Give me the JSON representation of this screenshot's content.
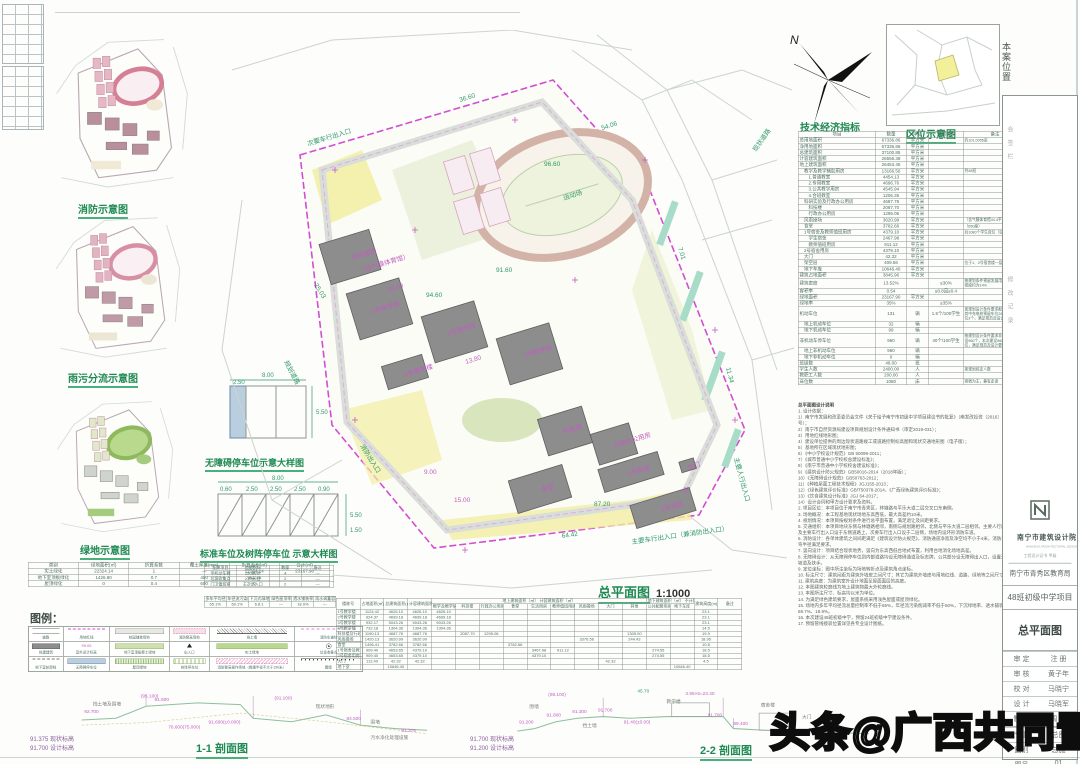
{
  "sheet": {
    "plan_title": "总平面图",
    "plan_scale": "1:1000"
  },
  "thumbnails": {
    "fire": "消防示意图",
    "rain": "雨污分流示意图",
    "green": "绿地示意图"
  },
  "details": {
    "accessible": "无障碍停车位示意大样图",
    "standard": "标准车位及树阵停车位 示意大样图",
    "dims1": [
      "8.00",
      "2.50",
      "5.50"
    ],
    "dims2": [
      "8.00",
      "0.60",
      "2.50",
      "2.50",
      "2.50",
      "0.90",
      "5.50",
      "1.50"
    ]
  },
  "locator": {
    "caption": "区位示意图",
    "site_label": "本案位置",
    "north": "N"
  },
  "green_table": {
    "columns": [
      "类别",
      "绿地面积(㎡)",
      "折算系数",
      "覆土厚度(mm)",
      "折算面积(㎡)",
      "合计(㎡)"
    ],
    "rows": [
      [
        "实土绿化",
        "22324.14",
        "1",
        "—",
        "22324.14",
        "23167.90"
      ],
      [
        "地下室顶板绿化",
        "1426.80",
        "0.7",
        "450",
        "961.76",
        ""
      ],
      [
        "屋顶绿化",
        "0",
        "0.4",
        "600",
        "0",
        ""
      ]
    ]
  },
  "facility_table": {
    "columns": [
      "配建项目",
      "控制指标",
      "数量",
      "备注"
    ],
    "rows": [
      [
        "非机动车棚",
        "150辆/处",
        "4",
        "—"
      ],
      [
        "垃圾收集点",
        "≥10㎡/处",
        "2",
        "—"
      ],
      [
        "门卫值班室",
        "主次出入口",
        "2",
        "—"
      ]
    ]
  },
  "sponge_table": {
    "columns": [
      "多年平均径流总量控制率",
      "年径流污染削减率",
      "下沉式绿地率",
      "绿色屋顶率",
      "透水铺装率",
      "雨水调蓄容积"
    ],
    "values": [
      "65.1%",
      "69.1%",
      "6.8:1",
      "—",
      "18.9%",
      "—"
    ]
  },
  "econ": {
    "title": "技术经济指标",
    "columns": [
      "项目",
      "数量",
      "单位",
      "规划条件",
      "备注"
    ],
    "rows": [
      [
        0,
        "总用地面积",
        "67336.86",
        "平方米",
        "",
        "约101.0055亩"
      ],
      [
        0,
        "净用地面积",
        "67336.86",
        "平方米",
        "",
        ""
      ],
      [
        0,
        "总建筑面积",
        "37100.85",
        "平方米",
        "",
        ""
      ],
      [
        0,
        "计容建筑面积",
        "26556.38",
        "平方米",
        "",
        ""
      ],
      [
        0,
        "地上建筑面积",
        "26453.45",
        "平方米",
        "",
        ""
      ],
      [
        1,
        "教学及教学辅助用房",
        "13166.56",
        "平方米",
        "",
        "共48班"
      ],
      [
        2,
        "1.普通教室",
        "4454.13",
        "平方米",
        "",
        ""
      ],
      [
        2,
        "2.专用教室",
        "4696.76",
        "平方米",
        "",
        ""
      ],
      [
        2,
        "3.公共教学用房",
        "4545.94",
        "平方米",
        "",
        ""
      ],
      [
        2,
        "4.合班教室",
        "1206.35",
        "平方米",
        "",
        ""
      ],
      [
        1,
        "科研实验及行政办公用房",
        "4687.76",
        "平方米",
        "",
        ""
      ],
      [
        2,
        "科技楼",
        "2087.70",
        "平方米",
        "",
        ""
      ],
      [
        2,
        "行政办公用房",
        "1295.06",
        "平方米",
        "",
        ""
      ],
      [
        1,
        "风雨操场",
        "3620.99",
        "平方米",
        "",
        "（含气膜体育馆44.4平方米）"
      ],
      [
        1,
        "食堂",
        "3782.66",
        "平方米",
        "",
        "（650座）"
      ],
      [
        1,
        "1号宿舍及教师值班用房",
        "4379.10",
        "平方米",
        "",
        "共1080个学生床位（见备注）"
      ],
      [
        2,
        "学生宿舍",
        "2467.98",
        "平方米",
        "",
        ""
      ],
      [
        2,
        "教师值班用房",
        "911.12",
        "平方米",
        "",
        ""
      ],
      [
        1,
        "2号宿舍用房",
        "4379.10",
        "平方米",
        "",
        ""
      ],
      [
        1,
        "大门",
        "42.32",
        "平方米",
        "",
        ""
      ],
      [
        1,
        "架空层",
        "409.56",
        "平方米",
        "",
        "位于1、2号宿舍楼一层"
      ],
      [
        1,
        "地下车库",
        "10646.40",
        "平方米",
        "",
        ""
      ],
      [
        0,
        "建筑占地面积",
        "3845.96",
        "平方米",
        "",
        ""
      ],
      [
        0,
        "建筑密度",
        "13.52%",
        "",
        "≤30%",
        "按规划条件预留发展用地后本期建筑密度约为14%"
      ],
      [
        0,
        "容积率",
        "0.54",
        "",
        "≤0.8且≥0.4",
        ""
      ],
      [
        0,
        "绿地面积",
        "23167.90",
        "平方米",
        "",
        ""
      ],
      [
        0,
        "绿地率",
        "35%",
        "",
        "≥35%",
        ""
      ],
      [
        0,
        "机动车位",
        "131",
        "辆",
        "1.5个/100学生",
        "按规划设计条件要求配建机动车位，其中充电桩预留车位26个、无障碍车位3个，满足规范及设计要求"
      ],
      [
        1,
        "地上机动车位",
        "32",
        "辆",
        "",
        ""
      ],
      [
        1,
        "地下机动车位",
        "99",
        "辆",
        "",
        ""
      ],
      [
        0,
        "非机动车停车位",
        "960",
        "辆",
        "40个/100学生",
        "按规划设计条件要求非机动车位需建设960个，本次建设960个非机动车位，满足规范及设计要求"
      ],
      [
        1,
        "地上非机动车位",
        "960",
        "辆",
        "",
        ""
      ],
      [
        1,
        "地下非机动车位",
        "0",
        "辆",
        "",
        ""
      ],
      [
        0,
        "班级数",
        "48.00",
        "班",
        "",
        ""
      ],
      [
        0,
        "学生人数",
        "2400.00",
        "人",
        "",
        "按规划核定人数"
      ],
      [
        0,
        "教职工人数",
        "200.00",
        "人",
        "",
        ""
      ],
      [
        0,
        "床位数",
        "1080",
        "床",
        "",
        "寄宿为主，兼有走读"
      ]
    ]
  },
  "notes": {
    "title": "总平面图设计说明",
    "lines": [
      "1. 设计依据：",
      "1）南宁市发展和改革委员会文件《关于给予南宁市初级中学项目建议书的批复》（南发改投资〔2016〕16号）；",
      "2）南宁市自然资源局建设项目规划设计条件通知书（审定2019-031）；",
      "3）用地红线地形图；",
      "4）建设单位提供的周边现状道路竣工或道路控制标高图和现状交通地形图（电子版）；",
      "5）基地所在区域现状地形图；",
      "6）《中小学校设计规范》GB 50099-2011；",
      "7）《城市普通中小学校校舍建设标准》；",
      "8）《南宁市普通中小学校校舍建设标准》；",
      "9）《建筑设计防火规范》GB50016-2014（2018年版）；",
      "10）《无障碍设计规范》GB50763-2012；",
      "11）《种植屋面工程技术规程》JGJ155-2013；",
      "12）《绿色建筑评价标准》GB/T50378-2014、《广西绿色建筑评价标准》；",
      "13）《饮食建筑设计标准》JGJ 64-2017；",
      "14）设计合同和甲方设计要求及资料。",
      "2. 项目区位：本项目位于南宁市青秀区，林塘路与平乐大道二层交叉口东南侧。",
      "3. 场地概况：本工程基地现状场地东高西低，最大高差约10米。",
      "4. 规划情况：本项目按规划条件进行总平面布置，满足退让及间距要求。",
      "5. 交通组织：本项目地块东侧与林塘路相邻，南侧与规划路相邻，北侧与平乐大道二层相邻。主要人行出入口及主要车行出入口设于东侧道路上，次要车行出入口设于二层侧，场地内设环形消防车道。",
      "6. 消防设计：各单体建筑之间间距满足《建筑设计防火规范》，消防通道净宽及净空均不小于4米，消防车道转弯半径满足要求。",
      "7. 竖向设计：项目结合现状地势，竖向为东高西低台地式布置，利用台地消化场地高差。",
      "8. 无障碍设计：从无障碍停车位到内部道路均设无障碍通道及标志牌，公共部分设无障碍出入口，设置无障碍坡道及扶手。",
      "9. 定位坐标：图中所注坐标为场地转折点及建筑角点坐标。",
      "10. 标注尺寸：建筑间距为建筑外墙皮之间尺寸；其它为建筑外墙皮与用地红线、道路、绿地等之间尺寸。",
      "11. 建筑高度：为建筑室外设计地面至屋面面层的高度。",
      "12. 本图建筑轮廓线为地上建筑物最大外轮廓线。",
      "13. 本图所注尺寸、标高均以米为单位。",
      "14. 为满足绿色建筑要求，屋面系统采用浅色屋面或屋顶绿化。",
      "15. 场地内多年平均径流总量控制率不低于65%，年径流污染削减率不低于50%，下沉绿地率、透水铺装率为69.7%、18.9%。",
      "16. 本次建设48班初级中学，预留24班初级中学建设条件。",
      "17. 预留管线接驳位置详见各专业设计图纸。"
    ]
  },
  "legend": {
    "title": "图例：",
    "level_value": "99.05",
    "cells": [
      {
        "sym": "road",
        "label": "道路"
      },
      {
        "sym": "redline",
        "label": "用地红线"
      },
      {
        "sym": "paving",
        "label": "校园铺装场地"
      },
      {
        "sym": "fireline",
        "label": "消防登高场地"
      },
      {
        "sym": "retain",
        "label": "挡土墙"
      },
      {
        "sym": "firelane",
        "label": "消防车道线"
      },
      {
        "sym": "bldg",
        "label": "拟建建筑"
      },
      {
        "sym": "level",
        "label": "室外设计标高"
      },
      {
        "sym": "podium",
        "label": "地下室顶板覆土绿地"
      },
      {
        "sym": "entry",
        "label": "出入口"
      },
      {
        "sym": "solid-green",
        "label": "实土绿地"
      },
      {
        "sym": "trash",
        "label": "垃圾收集点"
      },
      {
        "sym": "basement",
        "label": "地下室轮廓线"
      },
      {
        "sym": "acc-park",
        "label": "无障碍停车位"
      },
      {
        "sym": "roof-green",
        "label": "屋顶绿地"
      },
      {
        "sym": "tree-park",
        "label": "树阵停车位"
      },
      {
        "sym": "fire-op",
        "label": "消防登高操作场地（救援半径不大于150米）"
      },
      {
        "sym": "wall",
        "label": "围墙"
      }
    ]
  },
  "building_table": {
    "h": {
      "col_no": "楼栋号",
      "col_fp": "占地面积(㎡)",
      "col_total": "总建筑面积(㎡)",
      "col_cap": "计容建筑面积(㎡)",
      "grp_above": "地上建筑面积（㎡）",
      "grp_cap": "计容建筑面积（㎡）",
      "sub": [
        "教学及教学辅助用房",
        "科技楼",
        "行政办公用房",
        "食堂",
        "生活用房",
        "教师值班用房",
        "风雨操场",
        "大门",
        "其他"
      ],
      "grp_below": "地下建筑面积（㎡）",
      "grp_nocap": "不计容建筑面积（㎡）",
      "sub2": [
        "公共配套用房",
        "地下车库"
      ],
      "col_h": "建筑高度(m)",
      "col_rm": "备注"
    },
    "rows": [
      [
        "1号教学楼",
        "1124.42",
        "4626.10",
        "4626.10",
        "4626.10",
        "",
        "",
        "",
        "",
        "",
        "",
        "",
        "",
        "",
        "",
        "23.1",
        ""
      ],
      [
        "2号教学楼",
        "924.37",
        "4699.18",
        "4699.18",
        "4699.18",
        "",
        "",
        "",
        "",
        "",
        "",
        "",
        "",
        "",
        "",
        "23.1",
        ""
      ],
      [
        "3号教学楼",
        "932.17",
        "5043.26",
        "5043.26",
        "5043.26",
        "",
        "",
        "",
        "",
        "",
        "",
        "",
        "",
        "",
        "",
        "23.1",
        ""
      ],
      [
        "4号教学楼",
        "732.18",
        "1304.36",
        "1304.36",
        "1304.36",
        "",
        "",
        "",
        "",
        "",
        "",
        "",
        "",
        "",
        "",
        "14.5",
        ""
      ],
      [
        "科技楼及行政办公用房",
        "1190.13",
        "4687.76",
        "4687.76",
        "",
        "2087.70",
        "1295.06",
        "",
        "",
        "",
        "",
        "",
        "1305.00",
        "",
        "",
        "19.9",
        ""
      ],
      [
        "风雨操场",
        "1420.13",
        "3620.99",
        "3620.99",
        "",
        "",
        "",
        "",
        "",
        "",
        "3376.56",
        "",
        "244.43",
        "",
        "",
        "18.95",
        ""
      ],
      [
        "食堂",
        "1496.41",
        "3782.66",
        "3782.66",
        "",
        "",
        "",
        "3782.66",
        "",
        "",
        "",
        "",
        "",
        "",
        "",
        "10.8",
        ""
      ],
      [
        "1号宿舍及教师值班用房",
        "909.40",
        "4653.65",
        "4379.10",
        "",
        "",
        "",
        "",
        "3467.98",
        "911.12",
        "",
        "",
        "",
        "274.55",
        "",
        "18.5",
        ""
      ],
      [
        "2号宿舍用房",
        "909.40",
        "4653.65",
        "4379.10",
        "",
        "",
        "",
        "",
        "4379.10",
        "",
        "",
        "",
        "",
        "274.55",
        "",
        "18.5",
        ""
      ],
      [
        "大门",
        "112.40",
        "42.32",
        "42.32",
        "",
        "",
        "",
        "",
        "",
        "",
        "",
        "42.32",
        "",
        "",
        "",
        "4.5",
        ""
      ],
      [
        "地下室",
        "",
        "10646.40",
        "",
        "",
        "",
        "",
        "",
        "",
        "",
        "",
        "",
        "",
        "",
        "10646.40",
        "",
        ""
      ]
    ]
  },
  "sections": {
    "s1": {
      "caption": "1-1 剖面图",
      "legend": [
        [
          "91.375",
          "现状标高"
        ],
        [
          "91.700",
          "设计标高"
        ]
      ],
      "labels": [
        {
          "x": 18,
          "y": 34,
          "t": "92.700",
          "c": "m"
        },
        {
          "x": 84,
          "y": 16,
          "t": "(95.100)",
          "c": "m"
        },
        {
          "x": 28,
          "y": 25,
          "t": "挡土墙及围墙",
          "c": "k"
        },
        {
          "x": 100,
          "y": 20,
          "t": "91.800",
          "c": "m"
        },
        {
          "x": 116,
          "y": 52,
          "t": "76.600(75.000)",
          "c": "m"
        },
        {
          "x": 163,
          "y": 46,
          "t": "91.600(±0.000)",
          "c": "m"
        },
        {
          "x": 240,
          "y": 18,
          "t": "(91.100)",
          "c": "m"
        },
        {
          "x": 288,
          "y": 28,
          "t": "现状地形",
          "c": "k"
        },
        {
          "x": 324,
          "y": 42,
          "t": "84.500",
          "c": "m"
        },
        {
          "x": 352,
          "y": 46,
          "t": "围墙",
          "c": "k"
        },
        {
          "x": 388,
          "y": 56,
          "t": "81.375",
          "c": "m"
        },
        {
          "x": 352,
          "y": 64,
          "t": "污水净化处理设施",
          "c": "k"
        }
      ]
    },
    "s2": {
      "caption": "2-2 剖面图",
      "legend": [
        [
          "91.700",
          "现状标高"
        ],
        [
          "91.200",
          "设计标高"
        ]
      ],
      "labels": [
        {
          "x": 24,
          "y": 28,
          "t": "围墙",
          "c": "k"
        },
        {
          "x": 46,
          "y": 14,
          "t": "(98.100)",
          "c": "m"
        },
        {
          "x": 150,
          "y": 10,
          "t": "45.70",
          "c": "g"
        },
        {
          "x": 12,
          "y": 46,
          "t": "91.200",
          "c": "m"
        },
        {
          "x": 44,
          "y": 38,
          "t": "91.800",
          "c": "m"
        },
        {
          "x": 74,
          "y": 34,
          "t": "91.300",
          "c": "m"
        },
        {
          "x": 104,
          "y": 32,
          "t": "91.700",
          "c": "m"
        },
        {
          "x": 86,
          "y": 50,
          "t": "挡土墙",
          "c": "k"
        },
        {
          "x": 134,
          "y": 46,
          "t": "91.40(±0.00)",
          "c": "m"
        },
        {
          "x": 184,
          "y": 22,
          "t": "教学楼",
          "c": "k"
        },
        {
          "x": 206,
          "y": 13,
          "t": "3.95×6=23.40",
          "c": "m"
        },
        {
          "x": 232,
          "y": 38,
          "t": "91.700",
          "c": "m"
        },
        {
          "x": 262,
          "y": 48,
          "t": "89.400",
          "c": "m"
        },
        {
          "x": 294,
          "y": 26,
          "t": "宿舍楼",
          "c": "k"
        },
        {
          "x": 342,
          "y": 40,
          "t": "大门",
          "c": "k"
        },
        {
          "x": 324,
          "y": 58,
          "t": "87.20(±0.00)",
          "c": "m"
        }
      ]
    }
  },
  "plan": {
    "annotations": [
      {
        "x": 160,
        "y": 284,
        "t": "1号教学楼",
        "c": "m",
        "r": -17
      },
      {
        "x": 236,
        "y": 306,
        "t": "2号教学楼",
        "c": "m",
        "r": -17
      },
      {
        "x": 312,
        "y": 328,
        "t": "3号教学楼",
        "c": "m",
        "r": -17
      },
      {
        "x": 193,
        "y": 347,
        "t": "4号教学楼",
        "c": "m",
        "r": -17
      },
      {
        "x": 352,
        "y": 404,
        "t": "科技楼",
        "c": "m",
        "r": -17
      },
      {
        "x": 402,
        "y": 418,
        "t": "行政办公用房",
        "c": "m",
        "r": -17
      },
      {
        "x": 140,
        "y": 230,
        "t": "风雨操场",
        "c": "m",
        "r": -17
      },
      {
        "x": 148,
        "y": 243,
        "t": "（含气膜体育馆）",
        "c": "m",
        "r": -17
      },
      {
        "x": 330,
        "y": 462,
        "t": "食堂",
        "c": "m",
        "r": -17
      },
      {
        "x": 416,
        "y": 446,
        "t": "1号宿舍",
        "c": "m",
        "r": -17
      },
      {
        "x": 450,
        "y": 482,
        "t": "2号宿舍",
        "c": "m",
        "r": -17
      },
      {
        "x": 476,
        "y": 440,
        "t": "大门",
        "c": "m",
        "r": -17
      },
      {
        "x": 352,
        "y": 170,
        "t": "运动场",
        "c": "g",
        "r": -17
      },
      {
        "x": 248,
        "y": 72,
        "t": "36.60",
        "c": "g",
        "r": -17
      },
      {
        "x": 390,
        "y": 100,
        "t": "54.06",
        "c": "g",
        "r": -17
      },
      {
        "x": 466,
        "y": 218,
        "t": "7.01",
        "c": "g",
        "r": 72
      },
      {
        "x": 514,
        "y": 338,
        "t": "11.34",
        "c": "g",
        "r": 75
      },
      {
        "x": 350,
        "y": 508,
        "t": "64.42",
        "c": "g",
        "r": -8
      },
      {
        "x": 102,
        "y": 255,
        "t": "25.03",
        "c": "g",
        "r": 58
      },
      {
        "x": 96,
        "y": 116,
        "t": "次要车行出入口",
        "c": "g",
        "r": -17
      },
      {
        "x": 522,
        "y": 428,
        "t": "主要人行出入口",
        "c": "g",
        "r": 75
      },
      {
        "x": 420,
        "y": 514,
        "t": "主要车行出入口（兼消防出入口）",
        "c": "g",
        "r": -8
      },
      {
        "x": 148,
        "y": 416,
        "t": "消防出入口",
        "c": "g",
        "r": 58
      },
      {
        "x": 284,
        "y": 242,
        "t": "91.60",
        "c": "g",
        "r": 0
      },
      {
        "x": 214,
        "y": 267,
        "t": "94.60",
        "c": "g",
        "r": 0
      },
      {
        "x": 382,
        "y": 476,
        "t": "87.20",
        "c": "g",
        "r": 0
      },
      {
        "x": 332,
        "y": 136,
        "t": "96.60",
        "c": "g",
        "r": 0
      },
      {
        "x": 176,
        "y": 262,
        "t": "42.60",
        "c": "m",
        "r": -17
      },
      {
        "x": 254,
        "y": 334,
        "t": "13.80",
        "c": "m",
        "r": -17
      },
      {
        "x": 212,
        "y": 444,
        "t": "9.00",
        "c": "m",
        "r": 0
      },
      {
        "x": 242,
        "y": 472,
        "t": "15.00",
        "c": "m",
        "r": 0
      },
      {
        "x": 544,
        "y": 122,
        "t": "现状道路",
        "c": "g",
        "r": -55
      },
      {
        "x": 72,
        "y": 332,
        "t": "规划道路",
        "c": "g",
        "r": 62
      }
    ]
  },
  "titleblock": {
    "institute": "南宁市建筑设计院",
    "institute_en": "NANNING ARCHITECTURAL DESIGN INSTITUTE",
    "cert": "工程设计证书 甲级",
    "client": "南宁市青秀区教育局",
    "project": "48班初级中学项目",
    "drawing": "总平面图",
    "sign_rows": [
      [
        "审 定",
        "注 册"
      ],
      [
        "审 核",
        "黄子年"
      ],
      [
        "校 对",
        "马晓宁"
      ],
      [
        "设 计",
        "马晓军"
      ],
      [
        "制 图",
        "周 进"
      ]
    ],
    "bottom": [
      [
        "专业",
        "总图"
      ],
      [
        "图别",
        "总施"
      ],
      [
        "图号",
        "01"
      ]
    ],
    "side_notes": [
      "会 签 栏",
      "修 改 记 录"
    ]
  },
  "watermark": "头条@广西共同置业",
  "colors": {
    "caption_green": "#1e8a52",
    "annotation_magenta": "#c05ec0",
    "boundary_magenta": "#d24dd2",
    "building_gray": "#8d8d8d",
    "landscape_yellow": "#f2eea2",
    "landscape_green": "#cfe0ae"
  }
}
